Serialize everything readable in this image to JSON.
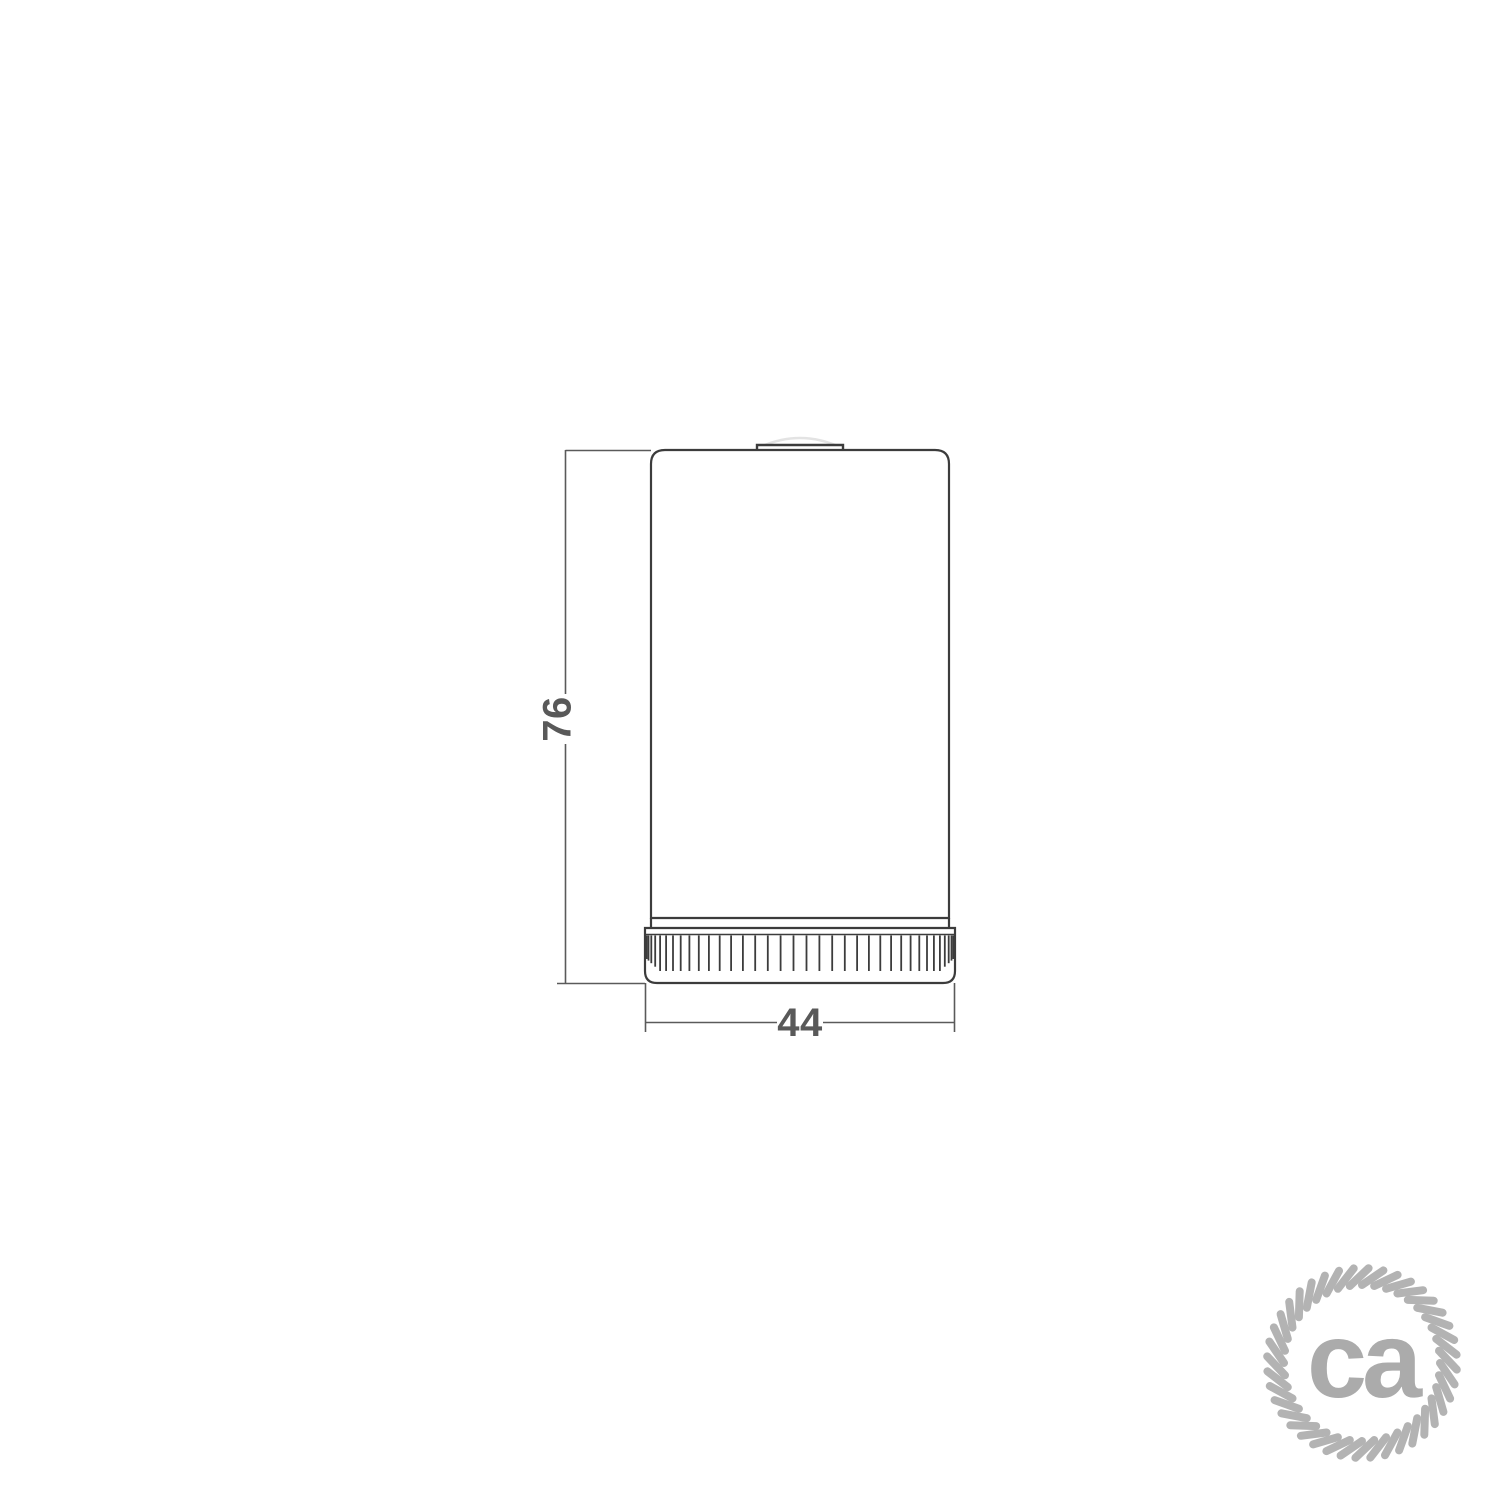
{
  "document": {
    "background_color": "#ffffff",
    "kind": "technical drawing"
  },
  "drawing": {
    "subject": "cylindrical-lamp-holder-side-view",
    "outline_color": "#3c3c3c",
    "dimension_line_color": "#5a5a5a",
    "dimension_text_color": "#595959",
    "height_dimension": {
      "value": "76"
    },
    "diameter_dimension": {
      "value": "44"
    },
    "knurl_rib_count": 36
  },
  "logo": {
    "text": "ca",
    "text_color": "#ababab",
    "rope_color": "#b3b3b3",
    "strand_count": 40
  }
}
